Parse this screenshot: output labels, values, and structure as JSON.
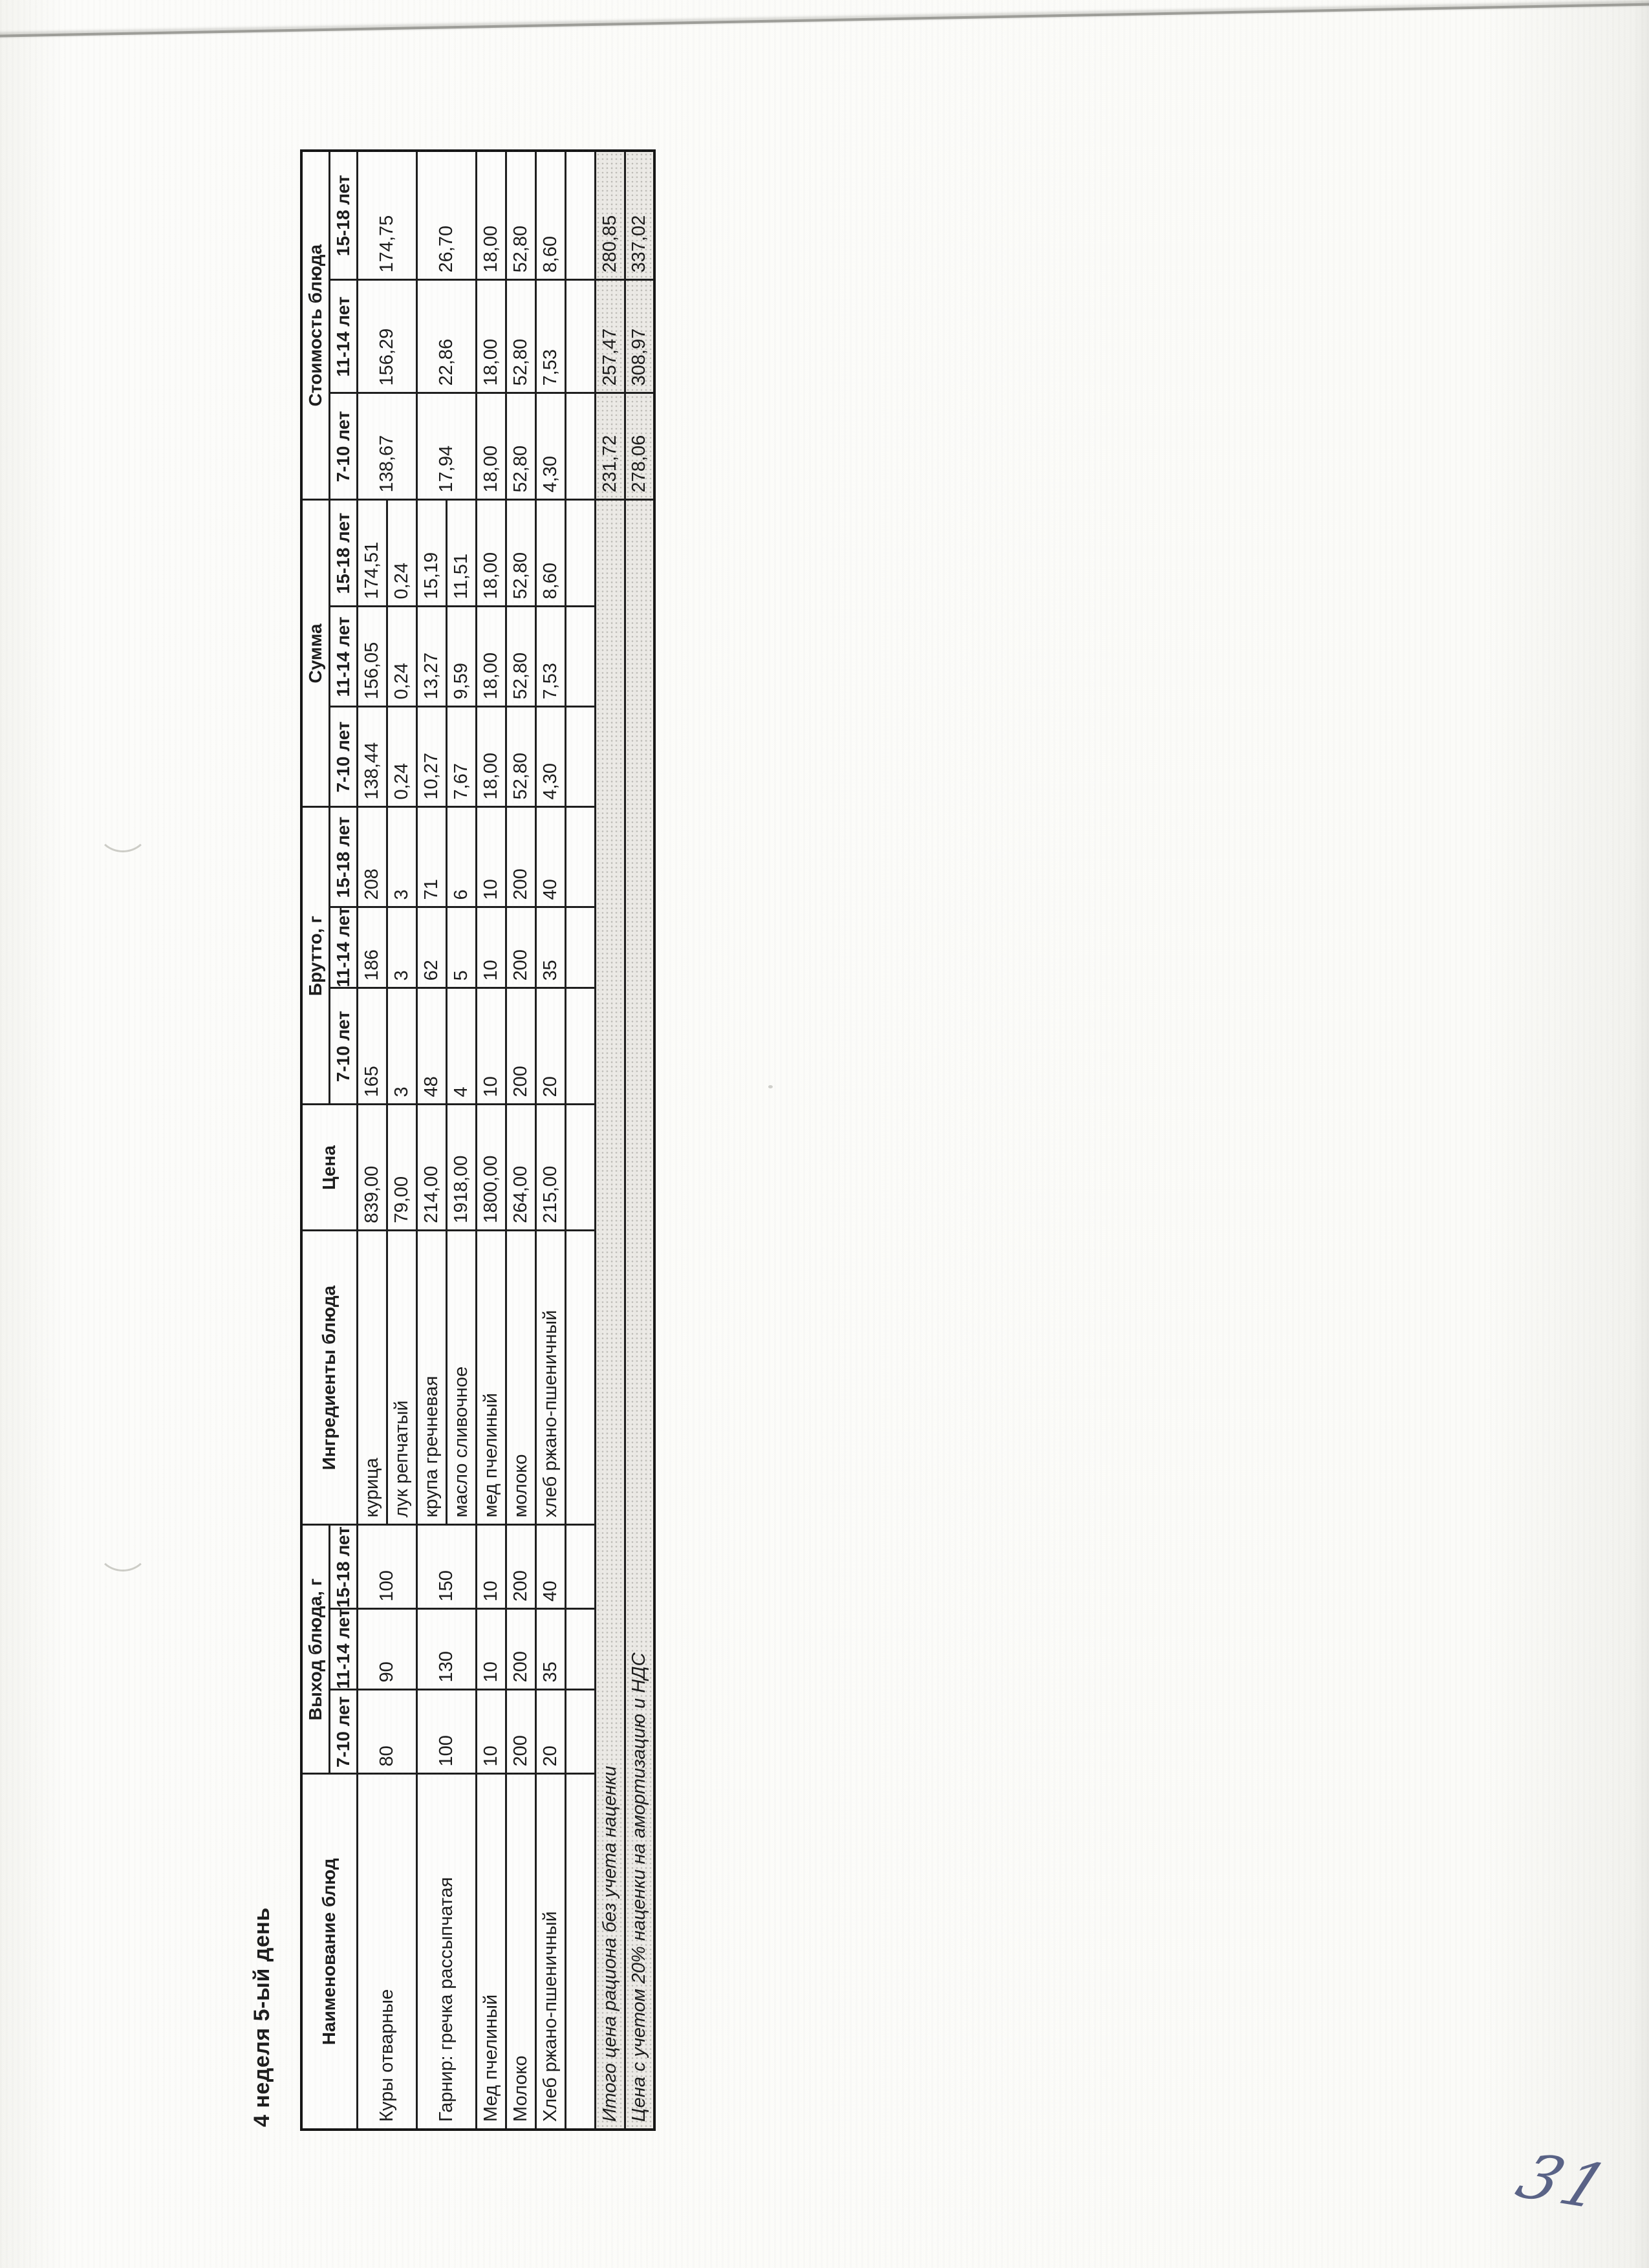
{
  "page": {
    "title": "4 неделя 5-ый день",
    "handwritten_page_number": "31",
    "ink_color": "#49537b"
  },
  "table": {
    "headers": {
      "name": "Наименование блюд",
      "output": "Выход блюда, г",
      "ingredients": "Ингредиенты блюда",
      "price": "Цена",
      "brutto": "Брутто, г",
      "summa": "Сумма",
      "cost": "Стоимость блюда"
    },
    "ages": [
      "7-10 лет",
      "11-14 лет",
      "15-18 лет"
    ],
    "rows": [
      {
        "name": "Куры отварные",
        "out": [
          "80",
          "90",
          "100"
        ],
        "ingredient": "курица",
        "price": "839,00",
        "brutto": [
          "165",
          "186",
          "208"
        ],
        "summa": [
          "138,44",
          "156,05",
          "174,51"
        ],
        "cost": [
          "138,67",
          "156,29",
          "174,75"
        ]
      },
      {
        "ingredient": "лук репчатый",
        "price": "79,00",
        "brutto": [
          "3",
          "3",
          "3"
        ],
        "summa": [
          "0,24",
          "0,24",
          "0,24"
        ]
      },
      {
        "name": "Гарнир: гречка рассыпчатая",
        "out": [
          "100",
          "130",
          "150"
        ],
        "ingredient": "крупа гречневая",
        "price": "214,00",
        "brutto": [
          "48",
          "62",
          "71"
        ],
        "summa": [
          "10,27",
          "13,27",
          "15,19"
        ],
        "cost": [
          "17,94",
          "22,86",
          "26,70"
        ]
      },
      {
        "ingredient": "масло сливочное",
        "price": "1918,00",
        "brutto": [
          "4",
          "5",
          "6"
        ],
        "summa": [
          "7,67",
          "9,59",
          "11,51"
        ]
      },
      {
        "name": "Мед пчелиный",
        "out": [
          "10",
          "10",
          "10"
        ],
        "ingredient": "мед пчелиный",
        "price": "1800,00",
        "brutto": [
          "10",
          "10",
          "10"
        ],
        "summa": [
          "18,00",
          "18,00",
          "18,00"
        ],
        "cost": [
          "18,00",
          "18,00",
          "18,00"
        ]
      },
      {
        "name": "Молоко",
        "out": [
          "200",
          "200",
          "200"
        ],
        "ingredient": "молоко",
        "price": "264,00",
        "brutto": [
          "200",
          "200",
          "200"
        ],
        "summa": [
          "52,80",
          "52,80",
          "52,80"
        ],
        "cost": [
          "52,80",
          "52,80",
          "52,80"
        ]
      },
      {
        "name": "Хлеб ржано-пшеничный",
        "out": [
          "20",
          "35",
          "40"
        ],
        "ingredient": "хлеб ржано-пшеничный",
        "price": "215,00",
        "brutto": [
          "20",
          "35",
          "40"
        ],
        "summa": [
          "4,30",
          "7,53",
          "8,60"
        ],
        "cost": [
          "4,30",
          "7,53",
          "8,60"
        ]
      }
    ],
    "totals": [
      {
        "label": "Итого цена рациона без учета наценки",
        "values": [
          "231,72",
          "257,47",
          "280,85"
        ]
      },
      {
        "label": "Цена с учетом 20% наценки на амортизацию и НДС",
        "values": [
          "278,06",
          "308,97",
          "337,02"
        ]
      }
    ]
  }
}
